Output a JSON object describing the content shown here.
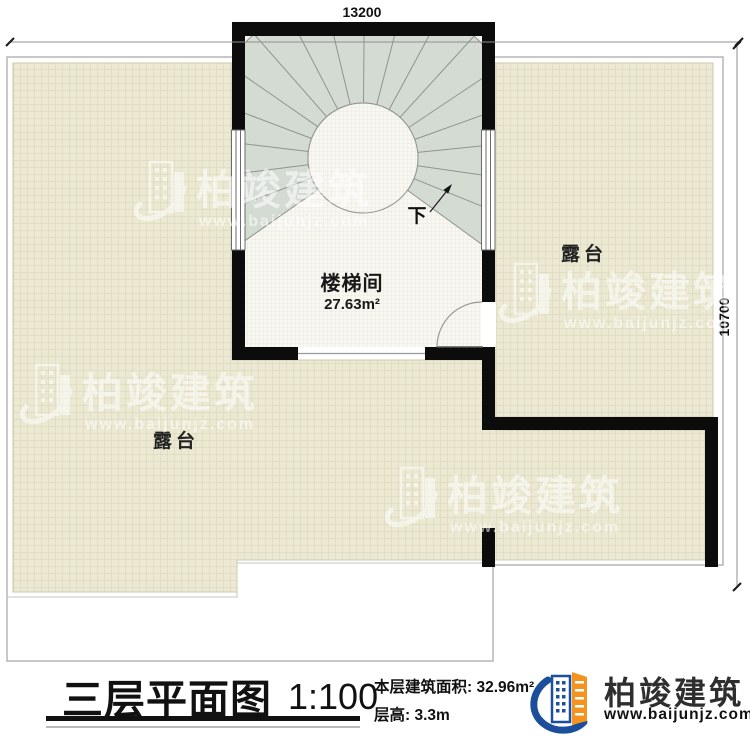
{
  "plan": {
    "dim_top": "13200",
    "dim_right": "10700",
    "room": {
      "name": "楼梯间",
      "area": "27.63m²"
    },
    "down_label": "下",
    "terrace_label_right": "露台",
    "terrace_label_bottom": "露台"
  },
  "watermark": {
    "brand": "柏竣建筑",
    "url": "www.baijunjz.com"
  },
  "titleblock": {
    "title": "三层平面图",
    "scale": "1:100",
    "area_label": "本层建筑面积:",
    "area_value": "32.96m²",
    "floor_height_label": "层高:",
    "floor_height_value": "3.3m",
    "brand": "柏竣建筑",
    "brand_url": "www.baijunjz.com"
  },
  "colors": {
    "wall_black": "#0c0c0c",
    "terrace_tile": "#ece9d3",
    "terrace_grid_line": "#d8d2b7",
    "stair_tread": "#d4dbd3",
    "stair_line": "#8f958e",
    "floor_light": "#f8f7f1",
    "outline_gray": "#b5b5b5",
    "logo_blue": "#1b4e9b",
    "logo_orange": "#f6921e"
  }
}
